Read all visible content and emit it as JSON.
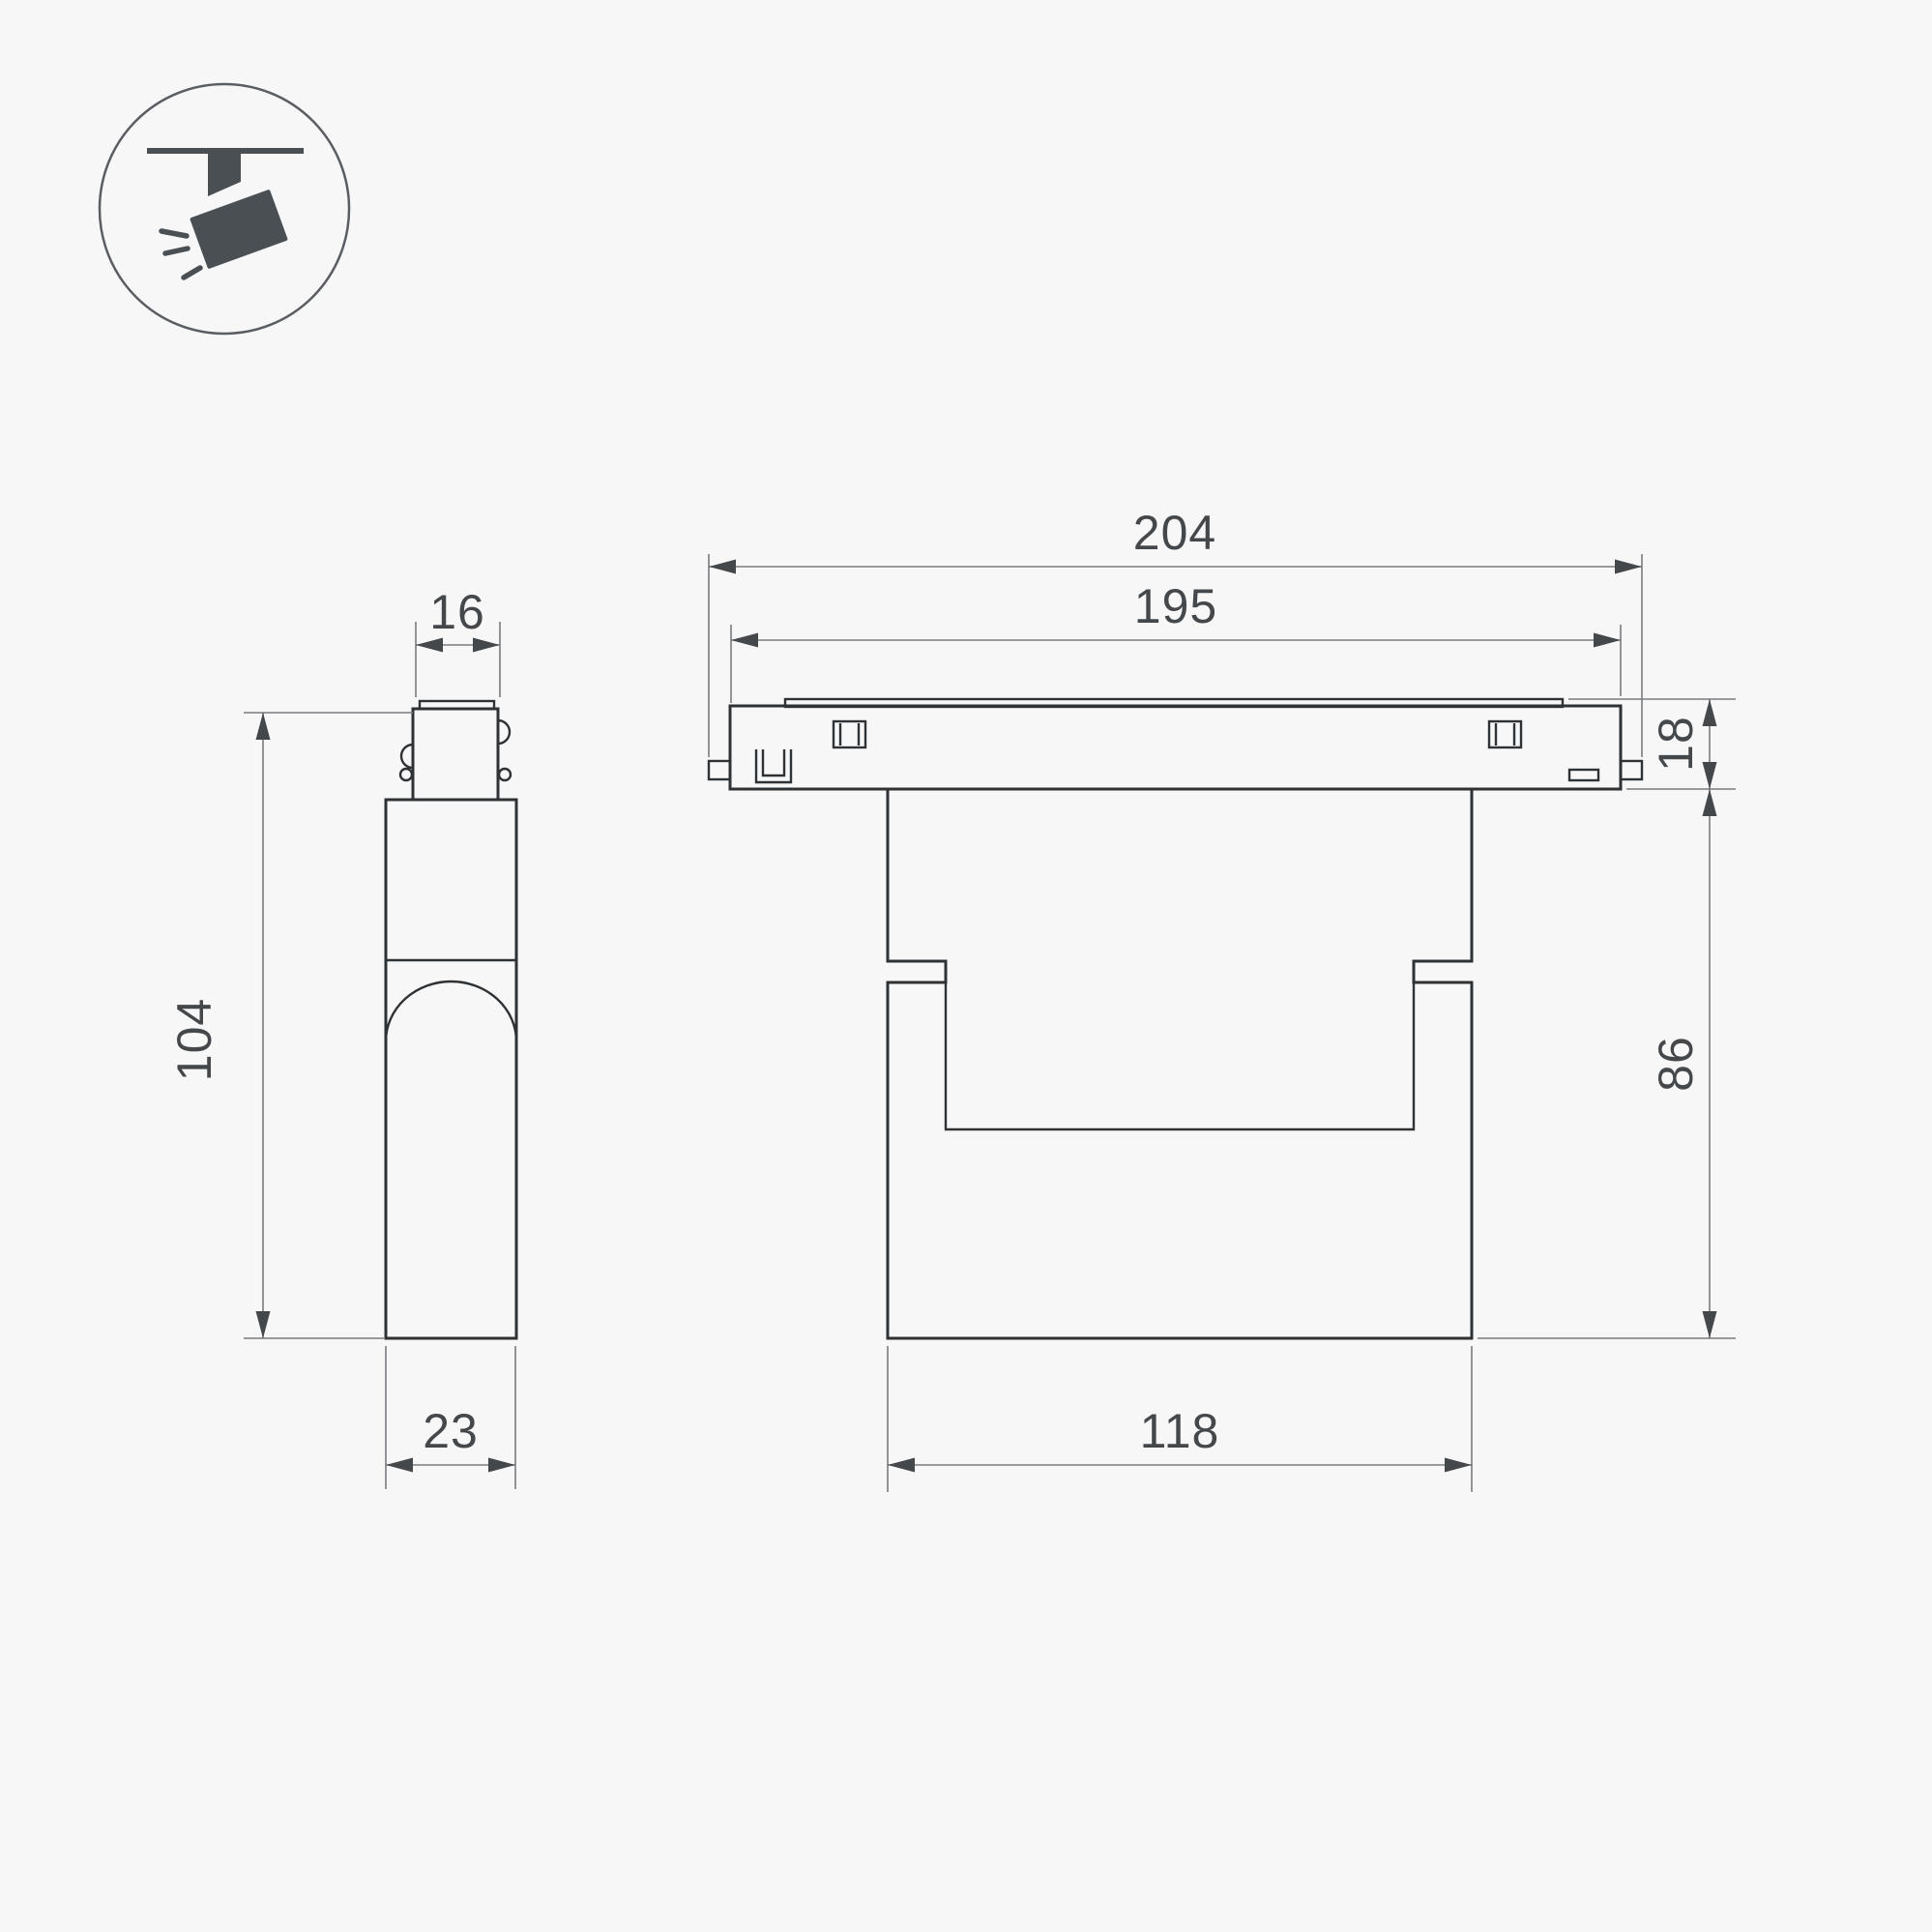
{
  "icon": {
    "name": "track-spotlight-icon",
    "color": "#4a4f54",
    "ring_color": "#5a5e63"
  },
  "style": {
    "outline_color": "#2f3235",
    "dimension_line_color": "#797c7f",
    "annotation_color": "#45484b",
    "background": "#f7f7f8"
  },
  "views": {
    "side": {
      "name": "side-view",
      "dims": {
        "top_width": "16",
        "height": "104",
        "depth": "23"
      }
    },
    "front": {
      "name": "front-view",
      "dims": {
        "overall_length": "204",
        "track_length": "195",
        "track_height": "18",
        "body_height": "86",
        "body_length": "118"
      }
    }
  }
}
